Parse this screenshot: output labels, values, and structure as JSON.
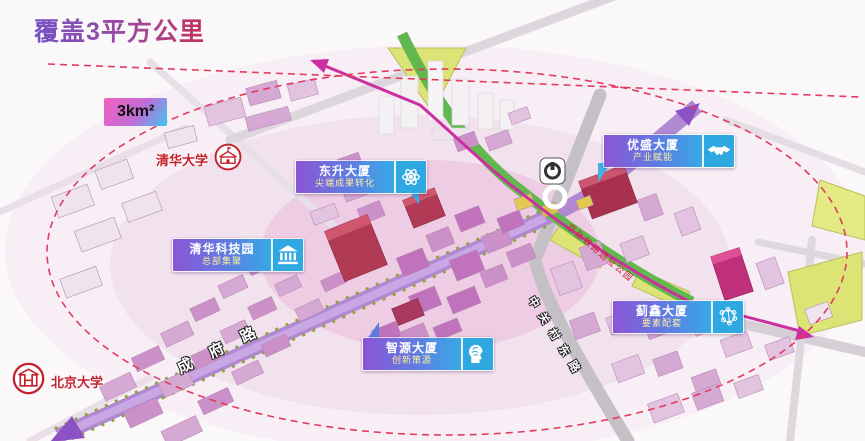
{
  "title": "覆盖3平方公里",
  "area_badge": "3km²",
  "universities": {
    "tsinghua": "清华大学",
    "peking": "北京大学"
  },
  "callouts": {
    "dongsheng": {
      "name": "东升大厦",
      "subtitle": "尖端成果转化",
      "icon": "atom-icon"
    },
    "tsinghua_science_park": {
      "name": "清华科技园",
      "subtitle": "总部集聚",
      "icon": "bank-icon"
    },
    "yousheng": {
      "name": "优盛大厦",
      "subtitle": "产业赋能",
      "icon": "handshake-icon"
    },
    "jixin": {
      "name": "蓟鑫大厦",
      "subtitle": "要素配套",
      "icon": "molecule-icon"
    },
    "zhiyuan": {
      "name": "智源大厦",
      "subtitle": "创新策源",
      "icon": "brain-icon"
    }
  },
  "roads": {
    "chengfu": "成府路",
    "zhongguancun_east": "中关村东路"
  },
  "park_label": "京张铁路遗址公园",
  "colors": {
    "title_gradient_start": "#7450c6",
    "title_gradient_end": "#c7305e",
    "coverage_dash": "#e23b5e",
    "callout_purple": "#8b55d6",
    "callout_blue": "#37a9e6",
    "road_purple": "#b188d4",
    "green_corridor": "#62b84e",
    "transit_magenta": "#cc2fa0",
    "university_red": "#c4232e"
  }
}
